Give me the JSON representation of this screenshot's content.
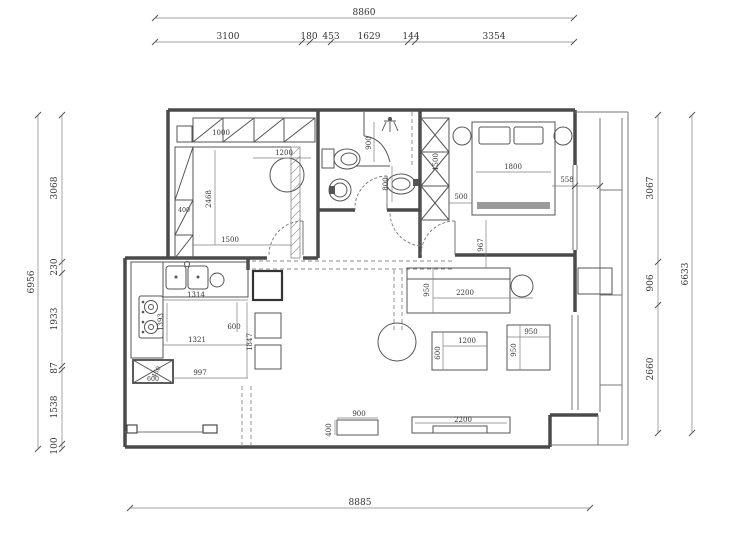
{
  "dimensions": {
    "top": {
      "overall": "8860",
      "segments": [
        "3100",
        "180",
        "453",
        "1629",
        "144",
        "3354"
      ]
    },
    "left": {
      "overall": "6956",
      "segments": [
        "3068",
        "230",
        "1933",
        "87",
        "1538",
        "100"
      ]
    },
    "right": {
      "overall": "6633",
      "segments": [
        "3067",
        "906",
        "2660"
      ]
    },
    "bottom": {
      "overall": "8885"
    }
  },
  "labels": {
    "b2_closet_top": "1000",
    "b2_table": "1200",
    "b2_closet_left": "400",
    "b2_depth": "2468",
    "b2_width": "1500",
    "bath_shower": "900",
    "bath_basin": "800",
    "mb_wardrobe_h": "1500",
    "mb_wardrobe_gap": "500",
    "mb_bed": "1800",
    "mb_right": "558",
    "mb_south": "967",
    "k_top": "1314",
    "k_left": "1393",
    "k_mid": "1321",
    "k_bottom": "997",
    "k_w": "600",
    "k_h": "1847",
    "k_box_w": "600",
    "k_box_d": "450",
    "lv_sofa_d": "950",
    "lv_sofa_w": "2200",
    "lv_table_w": "1200",
    "lv_table_d": "600",
    "lv_chair_w": "950",
    "lv_chair_d": "950",
    "lv_cab_w": "900",
    "lv_cab_d": "400",
    "lv_tv": "2200"
  }
}
